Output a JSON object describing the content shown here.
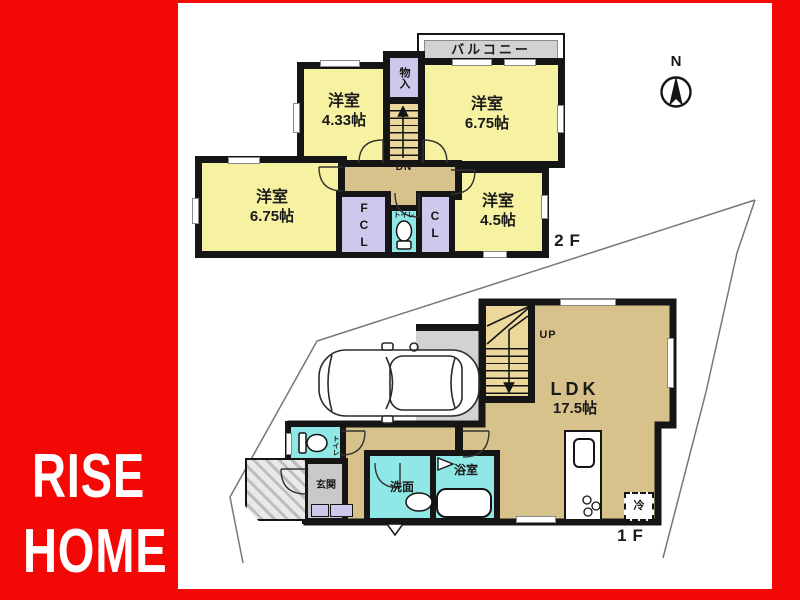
{
  "brand": {
    "line1": "RISE",
    "line2": "HOME"
  },
  "compass": {
    "north_label": "N"
  },
  "floor2": {
    "floor_label": "2F",
    "balcony_label": "バルコニー",
    "storage_label": "物入",
    "stairs_down_label": "DN",
    "fcl_label": "FCL",
    "cl_label": "CL",
    "toilet_label": "トイレ",
    "rooms": {
      "bedroom_a": {
        "name": "洋室",
        "size": "4.33帖"
      },
      "bedroom_b": {
        "name": "洋室",
        "size": "6.75帖"
      },
      "bedroom_c": {
        "name": "洋室",
        "size": "6.75帖"
      },
      "bedroom_d": {
        "name": "洋室",
        "size": "4.5帖"
      }
    }
  },
  "floor1": {
    "floor_label": "1F",
    "ldk": {
      "name": "LDK",
      "size": "17.5帖"
    },
    "stairs_up_label": "UP",
    "entrance_label": "玄関",
    "washroom_label": "洗面",
    "bathroom_label": "浴室",
    "toilet_label": "トイレ",
    "refrigerator_label": "冷"
  },
  "colors": {
    "frame_red": "#F40805",
    "room_yellow": "#F6F2A2",
    "hall_tan": "#D8C28C",
    "closet_lavender": "#CFC8EC",
    "wet_cyan": "#90E8E6",
    "balcony_gray": "#D2D2D2",
    "wall_black": "#151515"
  }
}
